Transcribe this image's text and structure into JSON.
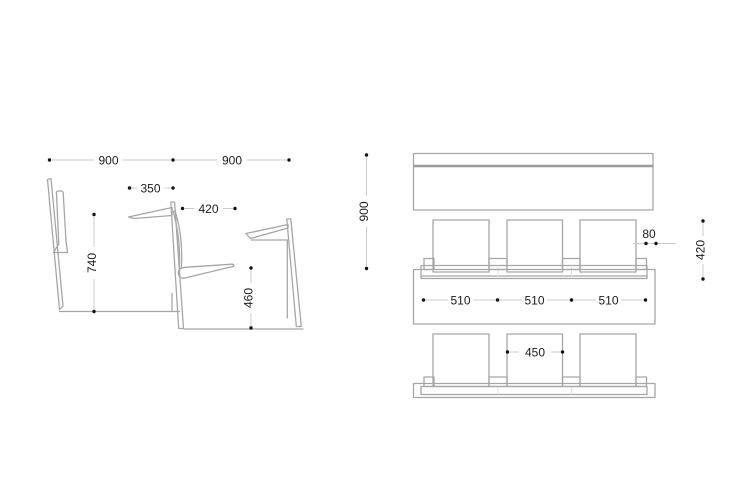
{
  "drawing": {
    "title": "seating-row-dimension-drawing",
    "side": {
      "view_name": "side-elevation",
      "dims": {
        "pitch_left": "900",
        "pitch_right": "900",
        "desk_depth": "350",
        "seat_depth": "420",
        "desk_height": "740",
        "seat_height": "460"
      }
    },
    "plan": {
      "view_name": "plan-view",
      "dims": {
        "row_pitch": "900",
        "spacing": [
          "510",
          "510",
          "510"
        ],
        "gap": "80",
        "depth": "420",
        "seat_width": "450"
      }
    },
    "colors": {
      "background": "#ffffff",
      "drawing_line": "#a6a6a6",
      "dimension_line": "#cbcbcb",
      "dimension_dot": "#141414",
      "text": "#1c1c1c"
    }
  }
}
